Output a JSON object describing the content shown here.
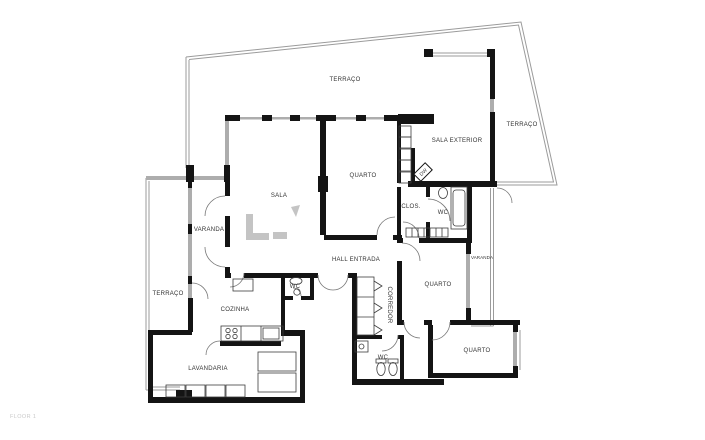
{
  "document": {
    "floor_note": "FLOOR 1"
  },
  "colors": {
    "background": "#ffffff",
    "wall": "#141414",
    "glazing": "#adadad",
    "boundary": "#9b9b9b",
    "fixture": "#3d3d3d",
    "door_arc": "#777777",
    "label": "#333333",
    "watermark": "#c4c4c4",
    "floor_note": "#c9c9c9"
  },
  "labels": [
    {
      "id": "terraco-top",
      "text": "TERRAÇO"
    },
    {
      "id": "terraco-right",
      "text": "TERRAÇO"
    },
    {
      "id": "sala-exterior",
      "text": "SALA EXTERIOR"
    },
    {
      "id": "quarto-1",
      "text": "QUARTO"
    },
    {
      "id": "sala",
      "text": "SALA"
    },
    {
      "id": "varanda-left",
      "text": "VARANDA"
    },
    {
      "id": "clos",
      "text": "CLOS."
    },
    {
      "id": "wc-suite",
      "text": "WC"
    },
    {
      "id": "varanda-right",
      "text": "VARANDA"
    },
    {
      "id": "hall-entrada",
      "text": "HALL ENTRADA"
    },
    {
      "id": "terraco-left",
      "text": "TERRAÇO"
    },
    {
      "id": "wc-hall",
      "text": "WC"
    },
    {
      "id": "quarto-2",
      "text": "QUARTO"
    },
    {
      "id": "corredor",
      "text": "CORREDOR"
    },
    {
      "id": "cozinha",
      "text": "COZINHA"
    },
    {
      "id": "wc-bottom",
      "text": "WC"
    },
    {
      "id": "quarto-3",
      "text": "QUARTO"
    },
    {
      "id": "lavandaria",
      "text": "LAVANDARIA"
    },
    {
      "id": "floor-note",
      "text": "FLOOR 1"
    },
    {
      "id": "dw-unit",
      "text": "DW"
    }
  ],
  "fixtures": [
    "bathtub",
    "sink",
    "toilet",
    "bidet",
    "kitchen-counter",
    "stove",
    "kitchen-sink",
    "fridge",
    "washer",
    "dryer",
    "wardrobe-shelves",
    "corridor-closet",
    "door-arc",
    "dw-diamond",
    "window",
    "railing"
  ]
}
